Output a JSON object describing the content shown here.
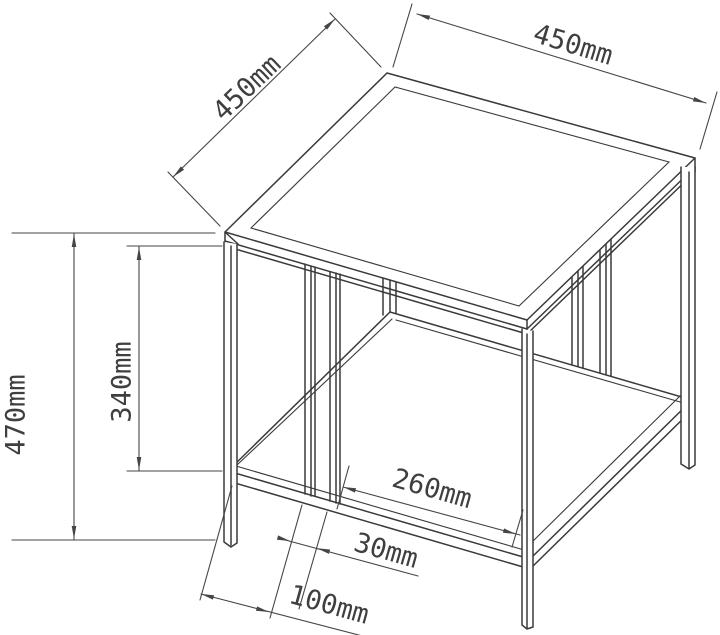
{
  "drawing": {
    "type": "technical-dimension-drawing",
    "object": "metal frame side table with lower shelf, isometric view",
    "background_color": "#ffffff",
    "line_color": "#3a3a3a",
    "dimension_color": "#454545",
    "dimensions": {
      "top_depth": "450mm",
      "top_width": "450mm",
      "overall_height": "470mm",
      "top_to_shelf": "340mm",
      "slat_to_front_leg": "260mm",
      "slat_spacing": "30mm",
      "leg_to_slat": "100mm"
    }
  }
}
